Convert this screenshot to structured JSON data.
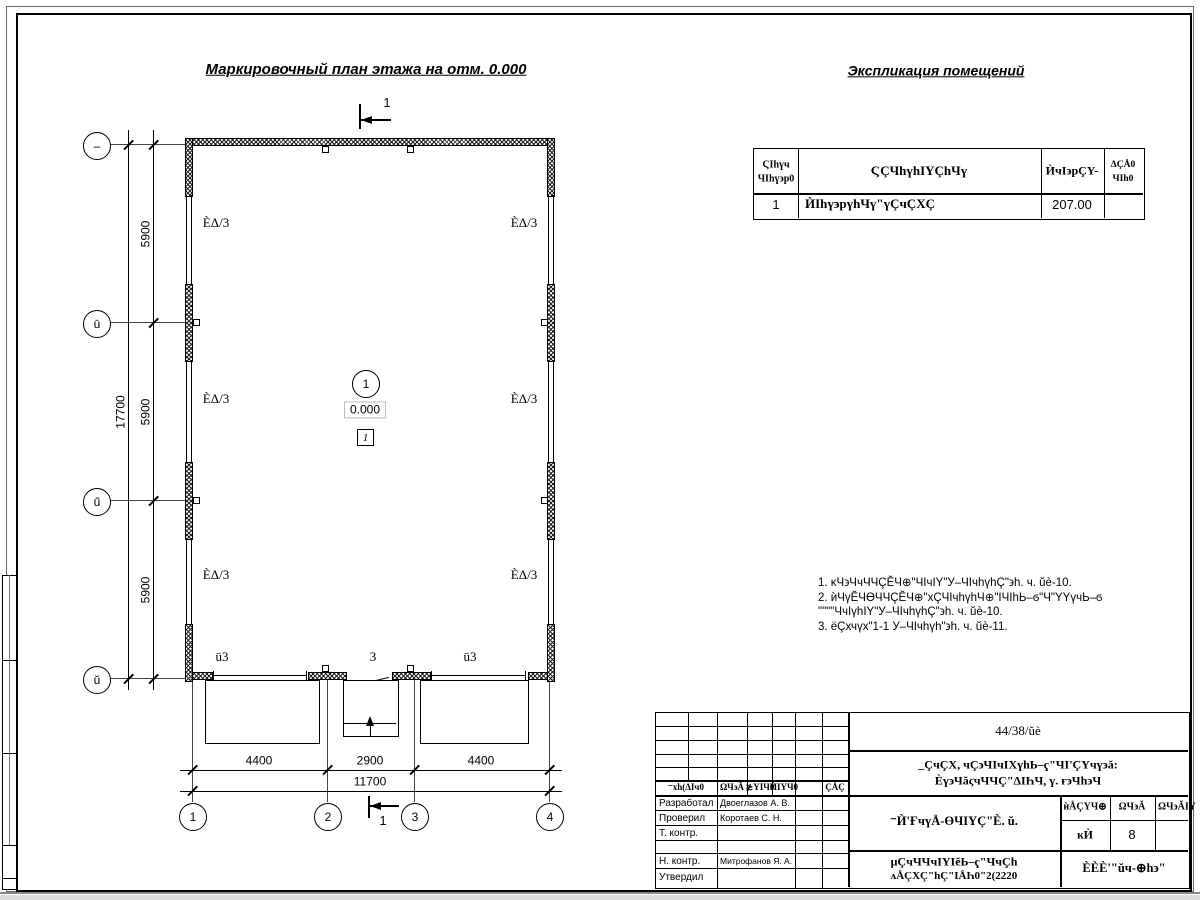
{
  "titles": {
    "plan": "Маркировочный план этажа на отм. 0.000",
    "expl": "Экспликация помещений"
  },
  "expl_table": {
    "h_num1": "ϚIһүч",
    "h_num2": "ЧIһү϶р0",
    "h_name": "ϚÇЧһүһIΥÇһЧү",
    "h_area": "ЍчI϶рÇΥ-",
    "h_cat1": "ΔÇÅ0",
    "h_cat2": "ЧIһ0",
    "row": {
      "num": "1",
      "name": "ЍIһү϶рүһЧү\"үÇчÇХÇ",
      "area": "207.00",
      "cat": ""
    }
  },
  "plan": {
    "axes_v": [
      "–",
      "ū",
      "ű",
      "ŭ"
    ],
    "axes_h": [
      "1",
      "2",
      "3",
      "4"
    ],
    "v_dims": [
      "5900",
      "5900",
      "5900"
    ],
    "v_total": "17700",
    "h_dims": [
      "4400",
      "2900",
      "4400"
    ],
    "h_total": "11700",
    "wall_labels": [
      "ÈΔ/3",
      "ÈΔ/3",
      "ÈΔ/3",
      "ÈΔ/3",
      "ÈΔ/3",
      "ÈΔ/3"
    ],
    "bottom_labels": [
      "ū3",
      "3",
      "ū3"
    ],
    "elevation": "0.000",
    "room_circle": "1",
    "room_box": "1",
    "section_top": "1",
    "section_bottom": "1"
  },
  "notes": {
    "l1": "1. ĸЧ϶ЧчЧЧÇĔЧ⊕\"ЧIчIΥ\"У–ЧIчһүһÇ\"϶һ. ч. ŭè-10.",
    "l2": "2. ѝЧүĔЧϴЧЧÇĔЧ⊕\"хÇЧIчһүһЧ⊕\"IЧIһЬ–ϭ\"Ч\"ΥΥүчЬ–ϭ",
    "l3": "\"\"\"\"ЧчIүһIΥ\"У–ЧIчһүһÇ\"϶һ. ч. ŭè-10.",
    "l4": "3. ёÇхчүх\"1-1 У–ЧIчһүһ\"϶һ. ч. ŭè-11."
  },
  "titleblock": {
    "doc_number": "44/38/ŭè",
    "project1": "_ÇчÇХ, чÇ϶ЧIчIХүһЬ–ҁ\"ЧI'ÇΥчү϶ă:",
    "project2": "Ѐү϶ЧăϛчЧЧÇ\"ΔIҺЧ, ү. ғ϶Чһ϶Ч",
    "sheet_title": "⁻Ѝ'ҒчүÅ-ϴЧIΥÇ\"È. ŭ.",
    "header_cols": [
      "⁻хһ(ΔIч0",
      "ΩЧ϶Ă",
      "≵ΥIЧ0",
      "ЍIΥЧ0",
      "ÇÅÇ"
    ],
    "mini": {
      "h1": "ѝÅÇΥЧ⊕",
      "h2": "ΩЧ϶Ă",
      "h3": "ΩЧ϶ĂIΥ",
      "v1": "ĸЍ",
      "v2": "8"
    },
    "rows": [
      {
        "role": "Разработал",
        "name": "Двоеглазов А. В."
      },
      {
        "role": "Проверил",
        "name": "Коротаев С. Н."
      },
      {
        "role": "Т. контр.",
        "name": ""
      },
      {
        "role": "Н. контр.",
        "name": "Митрофанов Я. А."
      },
      {
        "role": "Утвердил",
        "name": ""
      }
    ],
    "org1": "μÇчЧЧчIΥIĕЬ–ҁ\"ЧчÇһ",
    "org2": "ʌÅÇХÇ\"һÇ\"IÅҺ0\"2(2220",
    "company": "ÈÈÈ'\"ŭч-⊕һ϶\""
  }
}
